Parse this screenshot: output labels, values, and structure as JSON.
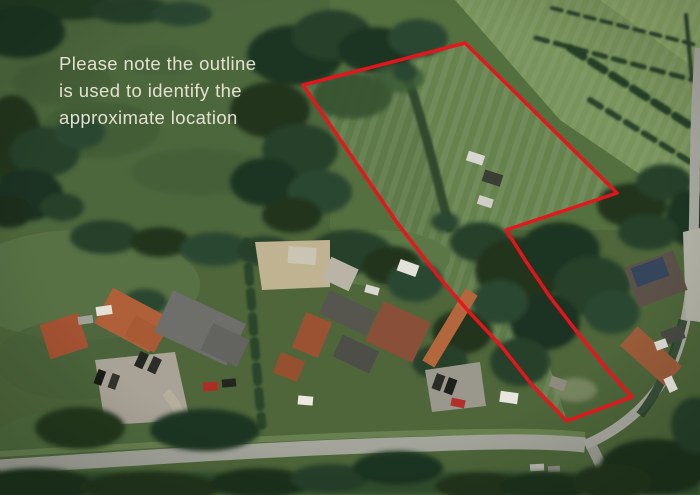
{
  "note": {
    "lines": [
      "Please note the outline",
      "is used to identify the",
      "approximate location"
    ],
    "color": "#ece8d9"
  },
  "outline": {
    "color": "#e9141d",
    "points": "303,85 465,43 617,193 506,230 527,263 550,297 577,332 606,368 632,397 567,421 532,385 502,347 470,313 438,276 398,224 348,151"
  }
}
